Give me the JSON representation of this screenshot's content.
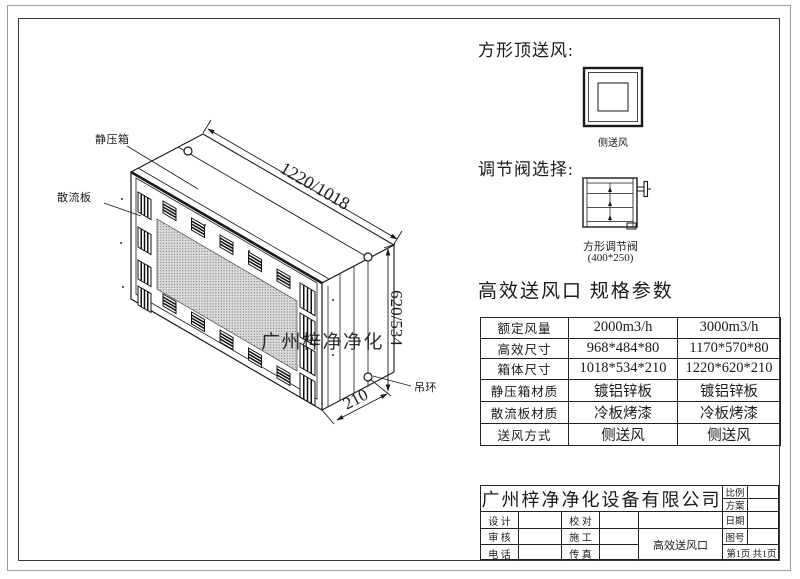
{
  "drawing": {
    "labels": {
      "static_pressure_box": "静压箱",
      "diffuser_plate": "散流板",
      "lifting_ring": "吊环"
    },
    "dimensions": {
      "width": "1220/1018",
      "height": "620/534",
      "depth": "210"
    },
    "watermark": "广州梓净净化"
  },
  "top_supply": {
    "heading": "方形顶送风:",
    "caption": "侧送风"
  },
  "valve": {
    "heading": "调节阀选择:",
    "caption": "方形调节阀",
    "size": "(400*250)"
  },
  "specs": {
    "heading": "高效送风口 规格参数",
    "rows": [
      {
        "label": "额定风量",
        "v1": "2000m3/h",
        "v2": "3000m3/h"
      },
      {
        "label": "高效尺寸",
        "v1": "968*484*80",
        "v2": "1170*570*80"
      },
      {
        "label": "箱体尺寸",
        "v1": "1018*534*210",
        "v2": "1220*620*210"
      },
      {
        "label": "静压箱材质",
        "v1": "镀铝锌板",
        "v2": "镀铝锌板"
      },
      {
        "label": "散流板材质",
        "v1": "冷板烤漆",
        "v2": "冷板烤漆"
      },
      {
        "label": "送风方式",
        "v1": "侧送风",
        "v2": "侧送风"
      }
    ]
  },
  "title_block": {
    "company": "广州梓净净化设备有限公司",
    "scale_label": "比例",
    "plan_label": "方案",
    "design_label": "设 计",
    "proof_label": "校 对",
    "date_label": "日期",
    "audit_label": "审 核",
    "construction_label": "施 工",
    "drawing_no_label": "图号",
    "phone_label": "电 话",
    "fax_label": "传 真",
    "title": "高效送风口",
    "page": "第1页 共1页"
  },
  "colors": {
    "line": "#1a1a1a",
    "mesh_fill": "#dcdcdc",
    "watermark": "#8a8a8a"
  }
}
